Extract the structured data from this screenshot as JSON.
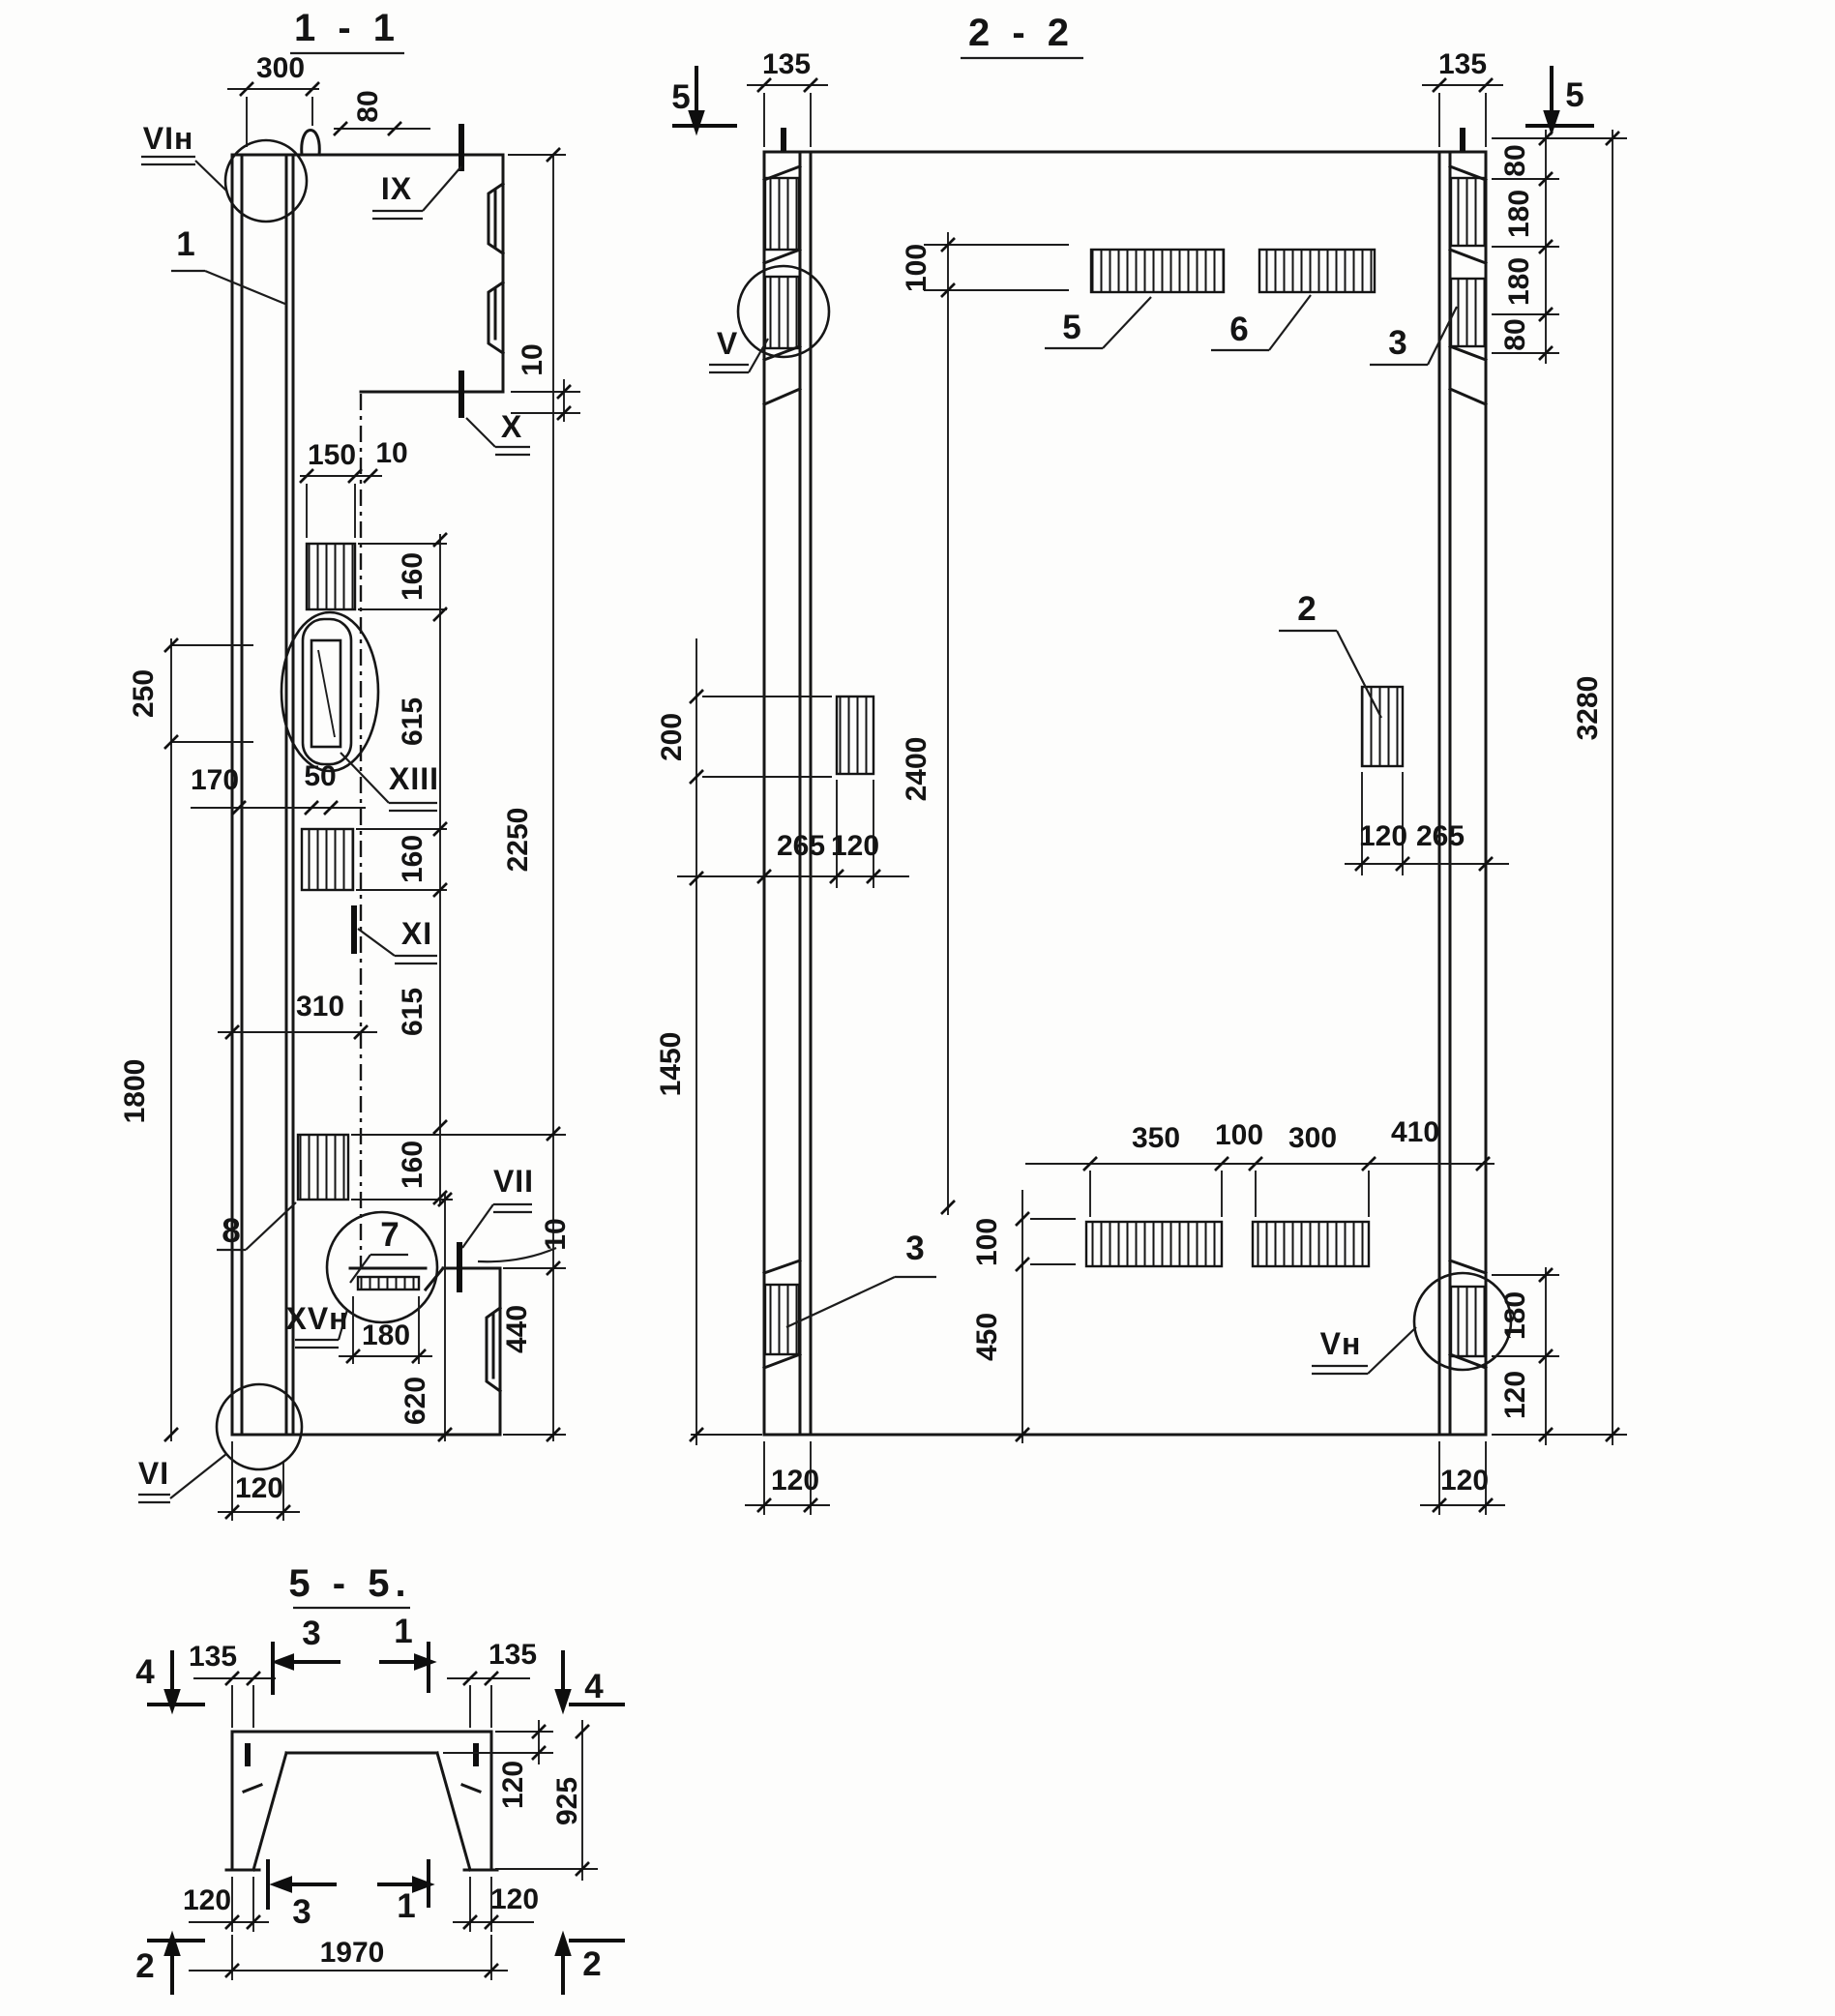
{
  "s11": {
    "title": "1 - 1",
    "d300": "300",
    "d80": "80",
    "d10_head": "10",
    "d150": "150",
    "d10_top": "10",
    "d160a": "160",
    "d615a": "615",
    "d160b": "160",
    "d615b": "615",
    "d160c": "160",
    "d2250": "2250",
    "d250": "250",
    "d170": "170",
    "d50": "50",
    "d1800": "1800",
    "d310": "310",
    "d10_bot": "10",
    "d180": "180",
    "d620": "620",
    "d440": "440",
    "d120": "120",
    "l_vin": "VIн",
    "l_1": "1",
    "l_ix": "IX",
    "l_x": "X",
    "l_xiii": "XIII",
    "l_xi": "XI",
    "l_8": "8",
    "l_7": "7",
    "l_vii": "VII",
    "l_xvn": "XVн",
    "l_vi": "VI"
  },
  "s22": {
    "title": "2 - 2",
    "m5l": "5",
    "m5r": "5",
    "d135l": "135",
    "d135r": "135",
    "d80a": "80",
    "d180a": "180",
    "d180b": "180",
    "d80b": "80",
    "d100t": "100",
    "d2400": "2400",
    "d100b": "100",
    "d450": "450",
    "d200": "200",
    "d265l": "265",
    "d120l": "120",
    "d120r": "120",
    "d265r": "265",
    "d1450": "1450",
    "d3280": "3280",
    "d350": "350",
    "d100r": "100",
    "d300": "300",
    "d410": "410",
    "d180c": "180",
    "d120c": "120",
    "d120bl": "120",
    "d120br": "120",
    "l_5": "5",
    "l_6": "6",
    "l_3t": "3",
    "l_3b": "3",
    "l_2": "2",
    "l_v": "V",
    "l_vn": "Vн"
  },
  "s55": {
    "title": "5 - 5.",
    "a3t": "3",
    "a1t": "1",
    "a4l": "4",
    "a4r": "4",
    "a3b": "3",
    "a1b": "1",
    "a2l": "2",
    "a2r": "2",
    "d135l": "135",
    "d135r": "135",
    "d120w": "120",
    "d925": "925",
    "d120bl": "120",
    "d120br": "120",
    "d1970": "1970"
  }
}
